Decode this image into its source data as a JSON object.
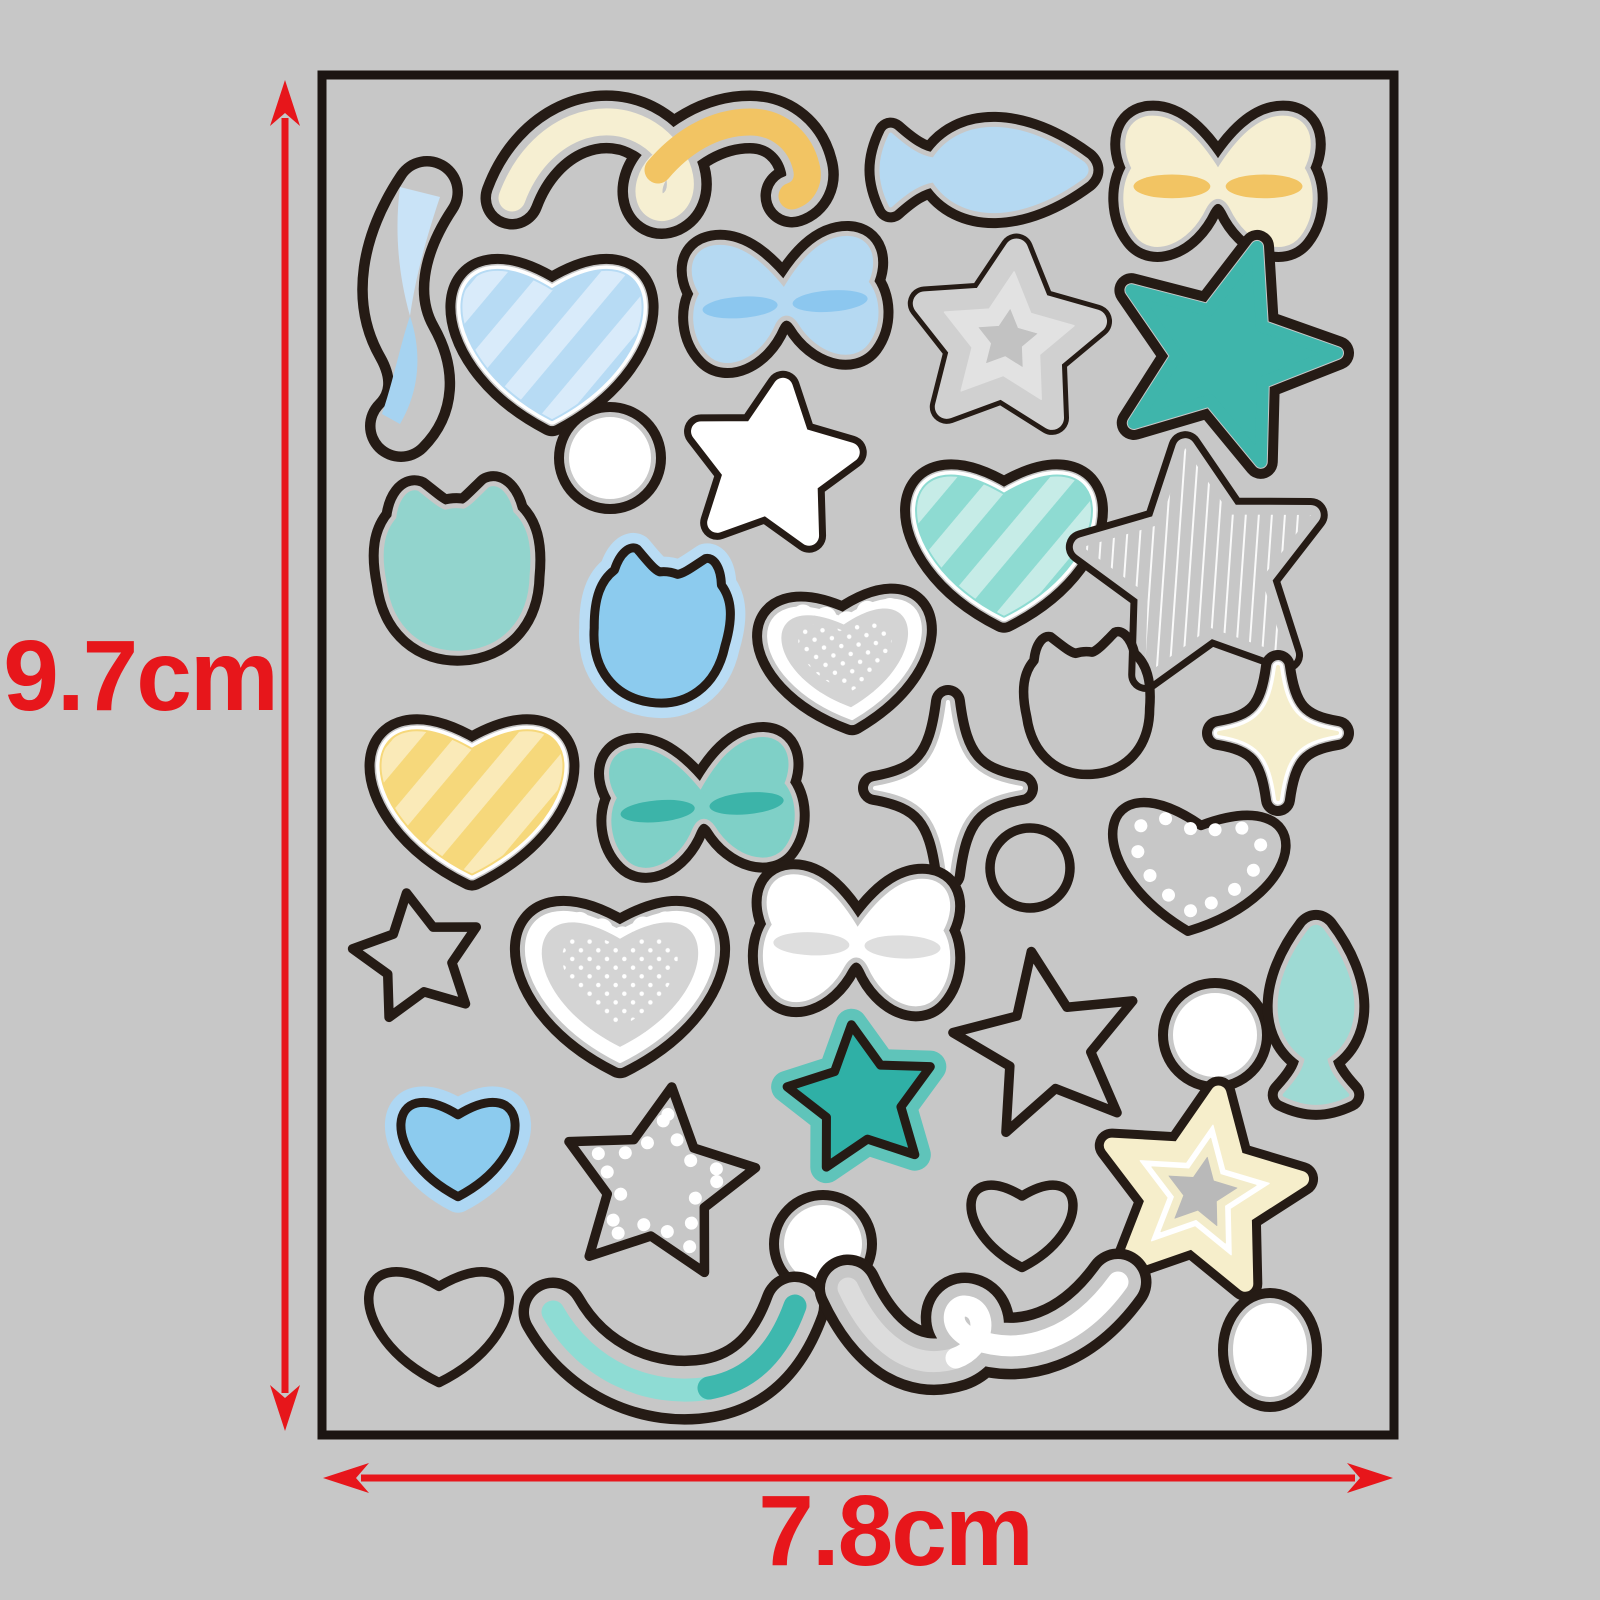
{
  "figure": {
    "description": "Sticker sheet dimension diagram",
    "canvas": {
      "width": 1600,
      "height": 1600
    }
  },
  "colors": {
    "background": "#c7c7c7",
    "outline": "#251b15",
    "dimension_red": "#e7161b",
    "white": "#ffffff",
    "lace_gray": "#d4d4d4"
  },
  "sheet": {
    "x": 322,
    "y": 75,
    "width": 1072,
    "height": 1360,
    "fill": "#c7c7c7",
    "border_color": "#1c1512",
    "border_width": 9
  },
  "dimensions": {
    "font_size": 100,
    "color": "#e7161b",
    "height": {
      "label": "9.7cm",
      "arrow": {
        "x": 285,
        "y1": 80,
        "y2": 1431
      },
      "label_x": 140,
      "label_y": 682
    },
    "width": {
      "label": "7.8cm",
      "arrow": {
        "y": 1478,
        "x1": 323,
        "x2": 1393
      },
      "label_x": 895,
      "label_y": 1537
    }
  },
  "stickers": [
    {
      "name": "ribbon-yellow",
      "shape": "ribbon",
      "cx": 660,
      "cy": 158,
      "contours": [
        {
          "d": "M -148,40 C -122,-30 -54,-56 -6,-20 C 24,4 28,38 8,48 C -10,56 -20,30 0,8",
          "w": 27
        },
        {
          "d": "M -2,12 C 20,-14 52,-36 90,-36 C 120,-36 140,-16 146,8 C 150,22 144,34 132,38",
          "w": 27
        }
      ],
      "fills": [
        {
          "d": "M -148,40 C -122,-30 -54,-56 -6,-20 C 24,4 28,38 8,48 C -10,56 -20,30 0,8",
          "w": 27,
          "color": "#f6efd2"
        },
        {
          "d": "M -2,12 C 20,-14 52,-36 90,-36 C 120,-36 140,-16 146,8 C 150,22 144,34 132,38",
          "w": 27,
          "color": "#f2c463"
        }
      ]
    },
    {
      "name": "fish-blue",
      "shape": "fish",
      "cx": 985,
      "cy": 170,
      "w": 205,
      "h": 104,
      "rot": 0,
      "style": "fill",
      "fill": "#b5d9f2"
    },
    {
      "name": "bow-cream",
      "shape": "bow",
      "cx": 1218,
      "cy": 185,
      "w": 192,
      "h": 140,
      "rot": 0,
      "style": "fill",
      "fill": "#f6efd2",
      "band": "#f2c463"
    },
    {
      "name": "swoosh-blue",
      "shape": "ribbon",
      "cx": 409,
      "cy": 308,
      "contours": [
        {
          "d": "M 18,-116 C -18,-62 -26,-8 -2,34 C 16,66 14,96 -8,118",
          "w": 36
        }
      ],
      "fills": [
        {
          "d": "M -9,-121 L 31,-111 C 13,-58 5,-20 1,8 C -12,-38 -14,-82 -9,-121 Z",
          "w": 0,
          "color": "#c9e3f7"
        },
        {
          "d": "M 1,8 C 13,44 11,82 -9,116 L -27,106 C -15,70 -9,38 1,8 Z",
          "w": 0,
          "color": "#a6d3f1"
        }
      ]
    },
    {
      "name": "heart-striped-blue",
      "shape": "heart",
      "cx": 552,
      "cy": 330,
      "w": 204,
      "h": 198,
      "rot": 0,
      "style": "fill",
      "fill": "#b7dbf4",
      "border": "#ffffff",
      "pattern": {
        "kind": "stripes",
        "color": "#d9ebfa"
      }
    },
    {
      "name": "bow-blue",
      "shape": "bow",
      "cx": 785,
      "cy": 303,
      "w": 188,
      "h": 126,
      "rot": -4,
      "style": "fill",
      "fill": "#b5d9f2",
      "band": "#8cc7ef"
    },
    {
      "name": "star-in-star-gray",
      "shape": "star",
      "cx": 1007,
      "cy": 340,
      "r": 90,
      "ir": 0.52,
      "rot": 6,
      "round": 12,
      "style": "fill",
      "fill": "#d0d0d0",
      "rings": [
        [
          0.76,
          "#e2e2e2"
        ],
        [
          0.34,
          "#c2c2c2"
        ]
      ]
    },
    {
      "name": "star-teal",
      "shape": "star",
      "cx": 1224,
      "cy": 355,
      "r": 113,
      "ir": 0.42,
      "rot": 17,
      "round": 6,
      "style": "fill",
      "fill": "#3fb5ab"
    },
    {
      "name": "circle-white-1",
      "shape": "circle",
      "cx": 610,
      "cy": 458,
      "rx": 39,
      "ry": 39,
      "style": "fill",
      "fill": "#ffffff"
    },
    {
      "name": "star-white",
      "shape": "star",
      "cx": 772,
      "cy": 466,
      "r": 79,
      "ir": 0.5,
      "rot": 8,
      "round": 10,
      "style": "fill",
      "fill": "#ffffff"
    },
    {
      "name": "heart-striped-teal",
      "shape": "heart",
      "cx": 1004,
      "cy": 532,
      "w": 198,
      "h": 186,
      "rot": 0,
      "style": "fill",
      "fill": "#8edbd2",
      "border": "#ffffff",
      "pattern": {
        "kind": "stripes",
        "color": "#c6ece7"
      }
    },
    {
      "name": "star-pinstripe",
      "shape": "star",
      "cx": 1202,
      "cy": 568,
      "r": 121,
      "ir": 0.5,
      "rot": -8,
      "round": 10,
      "style": "fill",
      "fill": "#c7c7c7",
      "pattern": {
        "kind": "pinstripe"
      }
    },
    {
      "name": "cat-teal",
      "shape": "cat",
      "cx": 458,
      "cy": 576,
      "s": 158,
      "rot": -3,
      "style": "fill",
      "fill": "#92d4cd"
    },
    {
      "name": "cat-blue-halo",
      "shape": "cat",
      "cx": 660,
      "cy": 634,
      "s": 150,
      "rot": 8,
      "style": "halo",
      "fill": "#8ccbee",
      "halo": "#b9dcf4",
      "haloW": 15
    },
    {
      "name": "heart-lace-small",
      "shape": "heart",
      "cx": 846,
      "cy": 650,
      "w": 172,
      "h": 152,
      "rot": -5,
      "style": "lace"
    },
    {
      "name": "cat-outline",
      "shape": "cat",
      "cx": 1088,
      "cy": 710,
      "s": 140,
      "rot": -4,
      "style": "outline"
    },
    {
      "name": "sparkle-cream",
      "shape": "sparkle",
      "cx": 1278,
      "cy": 733,
      "w": 118,
      "h": 132,
      "rot": 0,
      "style": "fill",
      "fill": "#f5eecd",
      "border": "#ffffff"
    },
    {
      "name": "heart-striped-yellow",
      "shape": "heart",
      "cx": 472,
      "cy": 788,
      "w": 206,
      "h": 190,
      "rot": 0,
      "style": "fill",
      "fill": "#f6d87b",
      "border": "#ffffff",
      "pattern": {
        "kind": "stripes",
        "color": "#faeab8"
      }
    },
    {
      "name": "bow-teal",
      "shape": "bow",
      "cx": 702,
      "cy": 806,
      "w": 186,
      "h": 128,
      "rot": -5,
      "style": "fill",
      "fill": "#7fd0c7",
      "band": "#3cb4a9"
    },
    {
      "name": "sparkle-white",
      "shape": "sparkle",
      "cx": 948,
      "cy": 788,
      "w": 146,
      "h": 172,
      "rot": 0,
      "style": "fill",
      "fill": "#ffffff"
    },
    {
      "name": "circle-outline",
      "shape": "circle",
      "cx": 1030,
      "cy": 868,
      "rx": 40,
      "ry": 40,
      "style": "outline"
    },
    {
      "name": "heart-dotted-gray",
      "shape": "heart",
      "cx": 1197,
      "cy": 858,
      "w": 198,
      "h": 164,
      "rot": 7,
      "style": "dotline",
      "inset": 0.72
    },
    {
      "name": "star-outline-small",
      "shape": "star",
      "cx": 418,
      "cy": 958,
      "r": 66,
      "ir": 0.52,
      "rot": -10,
      "round": 12,
      "style": "outline"
    },
    {
      "name": "heart-lace-large",
      "shape": "heart",
      "cx": 620,
      "cy": 972,
      "w": 212,
      "h": 198,
      "rot": 0,
      "style": "lace"
    },
    {
      "name": "bow-white",
      "shape": "bow",
      "cx": 857,
      "cy": 944,
      "w": 190,
      "h": 136,
      "rot": 2,
      "style": "fill",
      "fill": "#ffffff",
      "band": "#dedede"
    },
    {
      "name": "star-outline-large",
      "shape": "star",
      "cx": 1048,
      "cy": 1046,
      "r": 96,
      "ir": 0.45,
      "rot": -10,
      "round": 5,
      "style": "outline"
    },
    {
      "name": "circle-white-2",
      "shape": "circle",
      "cx": 1215,
      "cy": 1035,
      "rx": 40,
      "ry": 40,
      "style": "fill",
      "fill": "#ffffff"
    },
    {
      "name": "fish-teal",
      "shape": "fish",
      "cx": 1316,
      "cy": 1014,
      "w": 176,
      "h": 92,
      "rot": -90,
      "style": "fill",
      "fill": "#9edad4"
    },
    {
      "name": "heart-halo-blue",
      "shape": "heart",
      "cx": 458,
      "cy": 1140,
      "w": 130,
      "h": 126,
      "rot": 0,
      "style": "halo",
      "fill": "#8ccbee",
      "halo": "#aed7f3",
      "haloW": 16
    },
    {
      "name": "star-dotted-white",
      "shape": "star",
      "cx": 658,
      "cy": 1185,
      "r": 99,
      "ir": 0.52,
      "rot": 8,
      "round": 12,
      "style": "dotline",
      "inset": 0.72
    },
    {
      "name": "star-halo-teal",
      "shape": "star",
      "cx": 862,
      "cy": 1100,
      "r": 76,
      "ir": 0.52,
      "rot": -8,
      "round": 10,
      "style": "halo",
      "fill": "#2fb0a6",
      "halo": "#5fc4ba",
      "haloW": 16
    },
    {
      "name": "heart-outline-small",
      "shape": "heart",
      "cx": 1022,
      "cy": 1218,
      "w": 116,
      "h": 110,
      "rot": 0,
      "style": "outline"
    },
    {
      "name": "star-concentric-cream",
      "shape": "star",
      "cx": 1201,
      "cy": 1193,
      "r": 101,
      "ir": 0.48,
      "rot": 10,
      "round": 8,
      "style": "fill",
      "fill": "#f6eecb",
      "border": "#ffffff",
      "rings": [
        [
          0.68,
          "#ffffff"
        ],
        [
          0.55,
          "#f3ecca"
        ],
        [
          0.36,
          "#b9b9b9"
        ]
      ]
    },
    {
      "name": "heart-outline-large",
      "shape": "heart",
      "cx": 439,
      "cy": 1316,
      "w": 160,
      "h": 148,
      "rot": 0,
      "style": "outline"
    },
    {
      "name": "circle-white-3",
      "shape": "circle",
      "cx": 823,
      "cy": 1244,
      "rx": 37,
      "ry": 37,
      "style": "fill",
      "fill": "#ffffff"
    },
    {
      "name": "ribbon-teal",
      "shape": "ribbon",
      "cx": 675,
      "cy": 1348,
      "contours": [
        {
          "d": "M -122,-36 C -88,24 -24,50 34,40 C 78,32 104,2 120,-42",
          "w": 33
        }
      ],
      "fills": [
        {
          "d": "M -122,-36 C -88,24 -24,50 34,40",
          "w": 23,
          "color": "#8edcd4"
        },
        {
          "d": "M 34,40 C 78,32 104,2 120,-42",
          "w": 23,
          "color": "#3eb8ae"
        }
      ]
    },
    {
      "name": "ribbon-white",
      "shape": "ribbon",
      "cx": 988,
      "cy": 1322,
      "contours": [
        {
          "d": "M -140,-34 C -114,22 -76,50 -32,36 C -4,26 0,-8 -18,-15 C -36,-22 -44,8 -12,18 C 34,34 88,18 130,-40",
          "w": 31
        }
      ],
      "fills": [
        {
          "d": "M -140,-34 C -114,22 -76,50 -32,36",
          "w": 21,
          "color": "#dcdcdc"
        },
        {
          "d": "M -32,36 C -4,26 0,-8 -18,-15 C -36,-22 -44,8 -12,18 C 34,34 88,18 130,-40",
          "w": 21,
          "color": "#ffffff"
        }
      ]
    },
    {
      "name": "oval-white",
      "shape": "circle",
      "cx": 1270,
      "cy": 1350,
      "rx": 35,
      "ry": 45,
      "style": "fill",
      "fill": "#ffffff"
    }
  ]
}
